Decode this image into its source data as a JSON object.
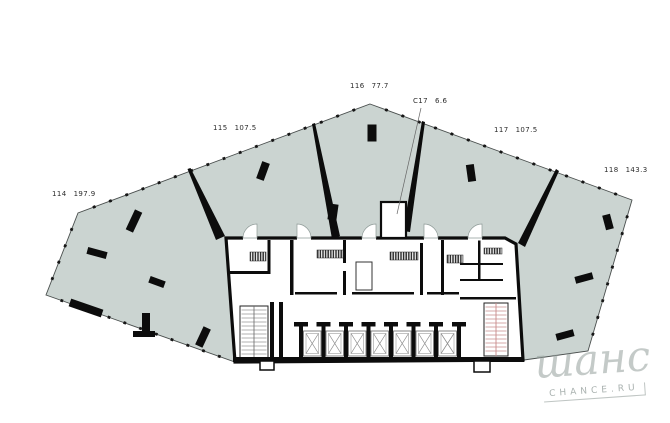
{
  "plan": {
    "units": [
      {
        "code": "114",
        "area": "197.9"
      },
      {
        "code": "115",
        "area": "107.5"
      },
      {
        "code": "116",
        "area": "77.7"
      },
      {
        "code": "C17",
        "area": "6.6"
      },
      {
        "code": "117",
        "area": "107.5"
      },
      {
        "code": "118",
        "area": "143.3"
      }
    ]
  },
  "watermark": {
    "name": "шанс",
    "caption": "CHANCE.RU"
  },
  "colors": {
    "background": "#ffffff",
    "floor_fill": "#cbd4d1",
    "walls": "#0c0c0c",
    "facade_line": "#4a4f4e",
    "stair_tread_accent": "#c98b8b"
  }
}
